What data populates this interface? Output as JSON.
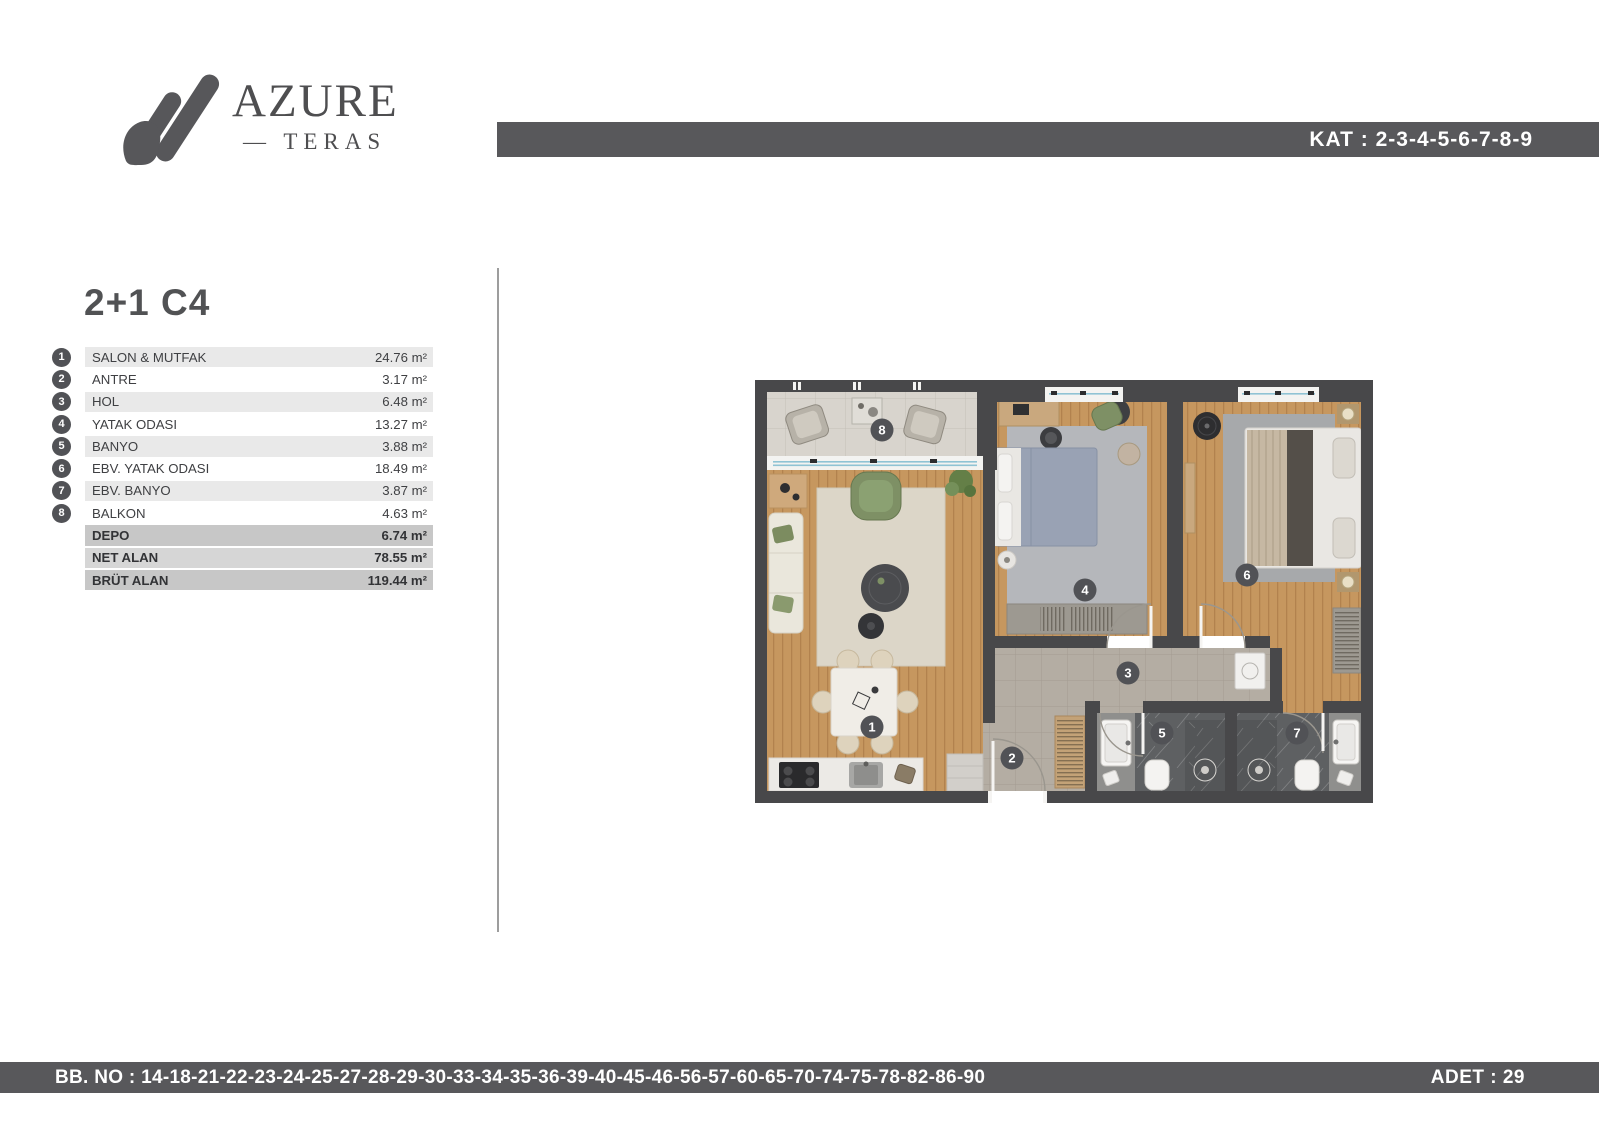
{
  "logo": {
    "title": "AZURE",
    "subtitle": "— TERAS"
  },
  "header": {
    "kat_label": "KAT : 2-3-4-5-6-7-8-9"
  },
  "unit": {
    "title": "2+1 C4",
    "rooms": [
      {
        "num": "1",
        "label": "SALON & MUTFAK",
        "area": "24.76 m²"
      },
      {
        "num": "2",
        "label": "ANTRE",
        "area": "3.17 m²"
      },
      {
        "num": "3",
        "label": "HOL",
        "area": "6.48 m²"
      },
      {
        "num": "4",
        "label": "YATAK ODASI",
        "area": "13.27 m²"
      },
      {
        "num": "5",
        "label": "BANYO",
        "area": "3.88 m²"
      },
      {
        "num": "6",
        "label": "EBV. YATAK ODASI",
        "area": "18.49 m²"
      },
      {
        "num": "7",
        "label": "EBV. BANYO",
        "area": "3.87 m²"
      },
      {
        "num": "8",
        "label": "BALKON",
        "area": "4.63 m²"
      }
    ],
    "summary": [
      {
        "label": "DEPO",
        "area": "6.74 m²"
      },
      {
        "label": "NET ALAN",
        "area": "78.55 m²"
      },
      {
        "label": "BRÜT ALAN",
        "area": "119.44 m²"
      }
    ]
  },
  "plan": {
    "badges": [
      "1",
      "2",
      "3",
      "4",
      "5",
      "6",
      "7",
      "8"
    ]
  },
  "footer": {
    "bb_no": "BB. NO : 14-18-21-22-23-24-25-27-28-29-30-33-34-35-36-39-40-45-46-56-57-60-65-70-74-75-78-82-86-90",
    "adet": "ADET : 29"
  },
  "colors": {
    "bar": "#58585b",
    "badge": "#515256",
    "window_glass": "#8fc3d4",
    "wall": "#48484a"
  }
}
